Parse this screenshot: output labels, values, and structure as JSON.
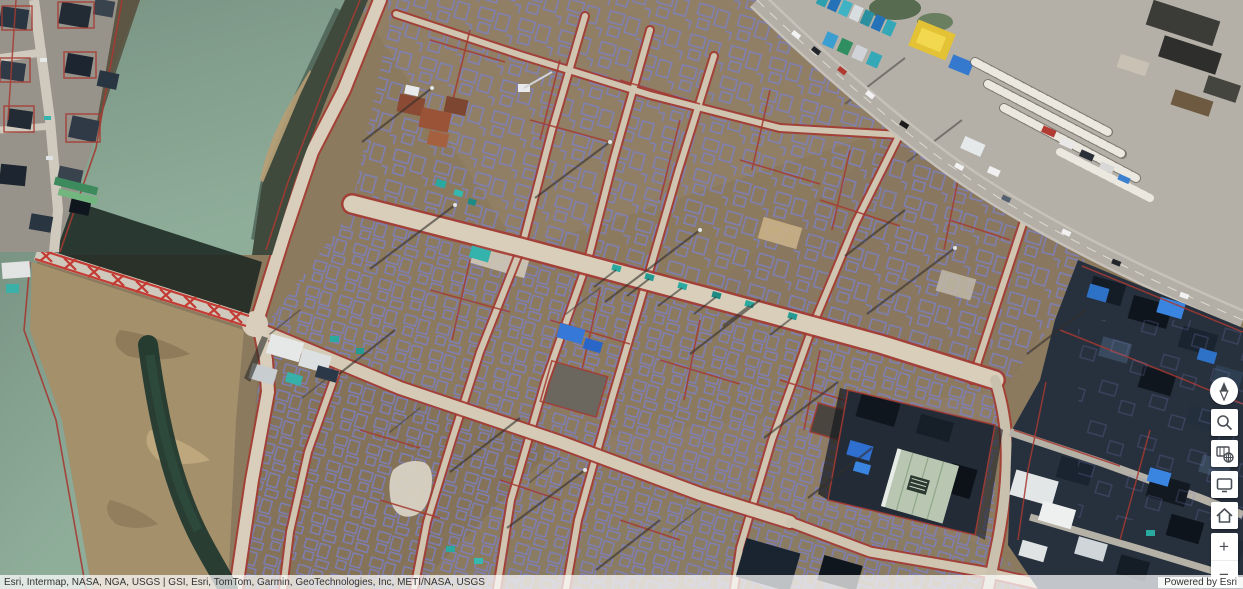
{
  "attribution": {
    "sources": "Esri, Intermap, NASA, NGA, USGS | GSI, Esri, TomTom, Garmin, GeoTechnologies, Inc, METI/NASA, USGS",
    "powered_by": "Powered by Esri"
  },
  "toolbar": {
    "buttons": [
      {
        "icon": "compass-icon"
      },
      {
        "icon": "search-icon"
      },
      {
        "icon": "basemap-gallery-icon"
      },
      {
        "icon": "overview-map-icon"
      },
      {
        "icon": "home-icon"
      },
      {
        "icon": "zoom-in-icon"
      },
      {
        "icon": "zoom-out-icon"
      }
    ],
    "zoom_in_label": "+",
    "zoom_out_label": "−"
  },
  "overlay": {
    "parcel_line_color": "#a53a32",
    "building_footprint_color": "#7b80c6",
    "water_color": "#82a08d",
    "dirt_color": "#8c7a5f",
    "road_color": "#d8ceba",
    "bridge_color": "#c33b32"
  }
}
